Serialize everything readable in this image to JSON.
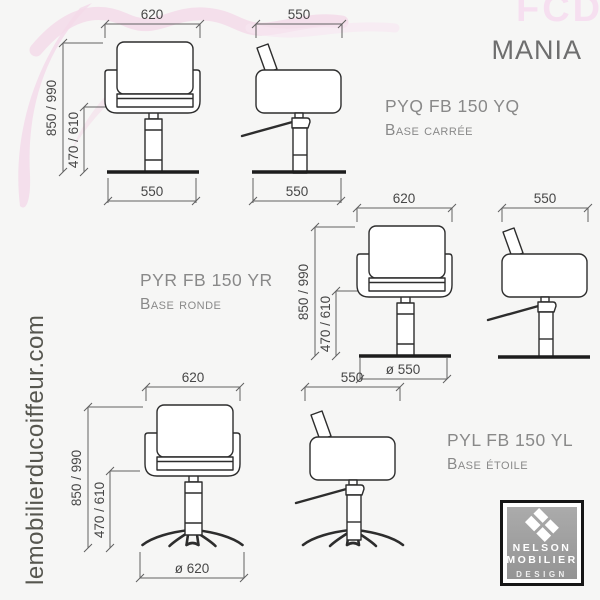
{
  "page": {
    "title": "MANIA",
    "brand_watermark": "FCD",
    "website": "lemobilierducoiffeur.com"
  },
  "products": [
    {
      "code": "PYQ FB 150 YQ",
      "base_label": "Base carrée"
    },
    {
      "code": "PYR FB 150 YR",
      "base_label": "Base ronde"
    },
    {
      "code": "PYL FB 150 YL",
      "base_label": "Base étoile"
    }
  ],
  "dimensions": {
    "row1": {
      "front_width_top": "620",
      "front_width_base": "550",
      "side_depth_top": "550",
      "side_depth_base": "550",
      "total_height": "850 / 990",
      "seat_height": "470 / 610"
    },
    "row2": {
      "front_width_top": "620",
      "base_diameter": "ø 550",
      "side_depth_top": "550",
      "total_height": "850 / 990",
      "seat_height": "470 / 610"
    },
    "row3": {
      "front_width_top": "620",
      "base_diameter": "ø 620",
      "side_depth_top": "550",
      "total_height": "850 / 990",
      "seat_height": "470 / 610"
    }
  },
  "logo": {
    "line1": "NELSON",
    "line2": "MOBILIER",
    "line3": "DESIGN"
  },
  "colors": {
    "accent_pink": "#f3d7e8",
    "line_dark": "#2d2d2d",
    "text_gray": "#898989"
  }
}
